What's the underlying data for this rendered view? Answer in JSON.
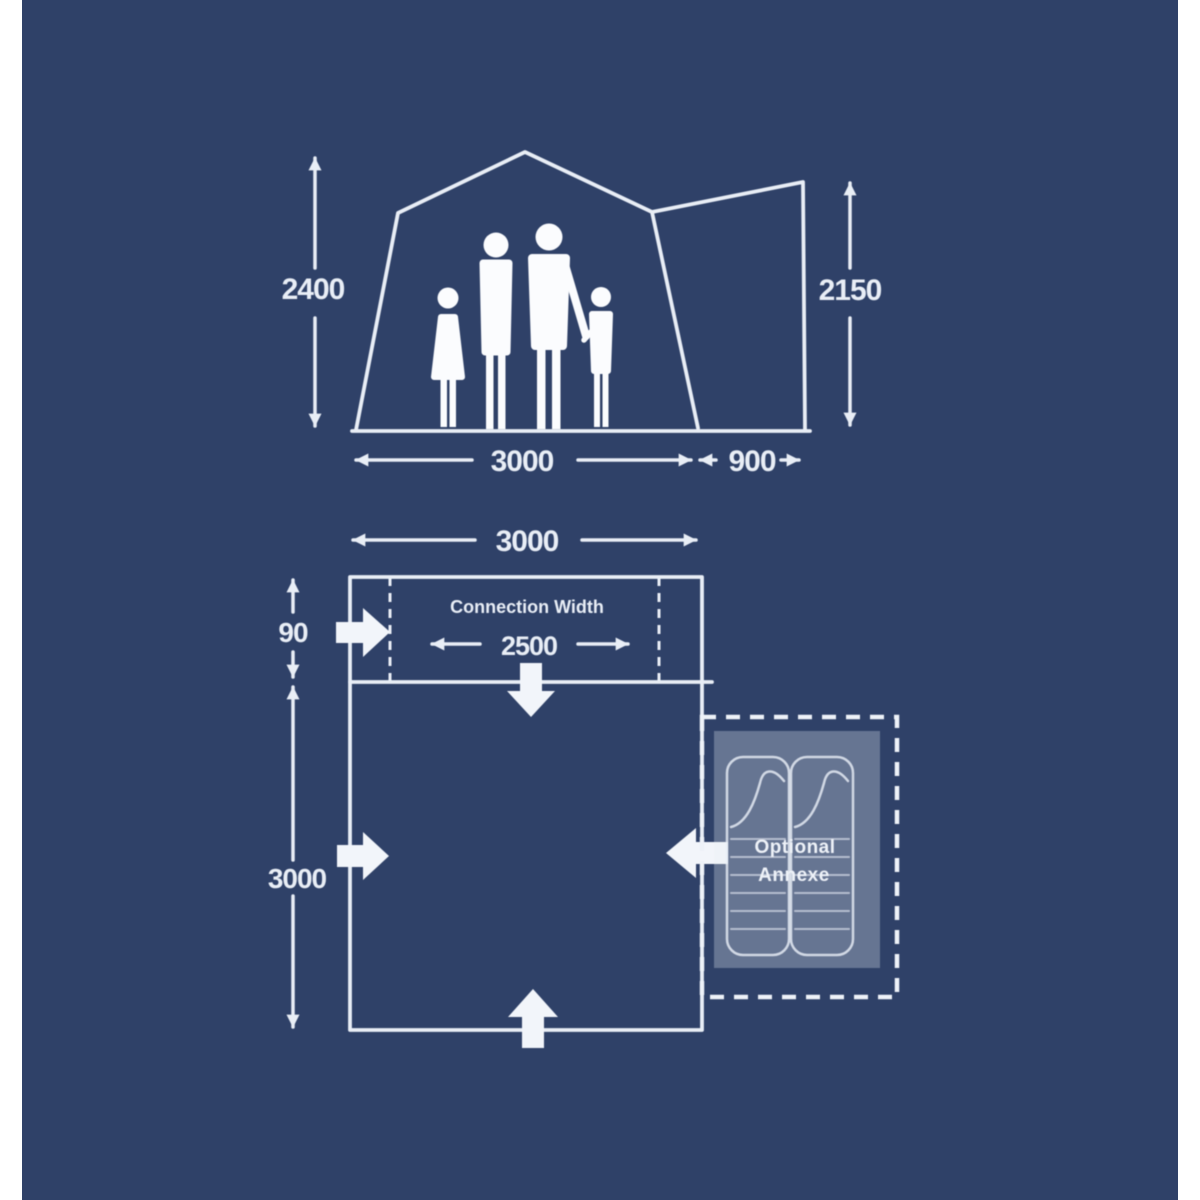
{
  "colors": {
    "background": "#2f4168",
    "line": "#e9eef6",
    "side_margin": "#ffffff",
    "annexe_fill": "rgba(233,238,246,0.30)"
  },
  "elevation": {
    "height_left_mm": "2400",
    "height_right_mm": "2150",
    "width_main_mm": "3000",
    "width_annexe_mm": "900"
  },
  "floorplan": {
    "width_top_mm": "3000",
    "connection_depth_mm": "90",
    "connection_width_label": "Connection Width",
    "connection_width_mm": "2500",
    "depth_mm": "3000",
    "annexe_label_line1": "Optional",
    "annexe_label_line2": "Annexe"
  }
}
